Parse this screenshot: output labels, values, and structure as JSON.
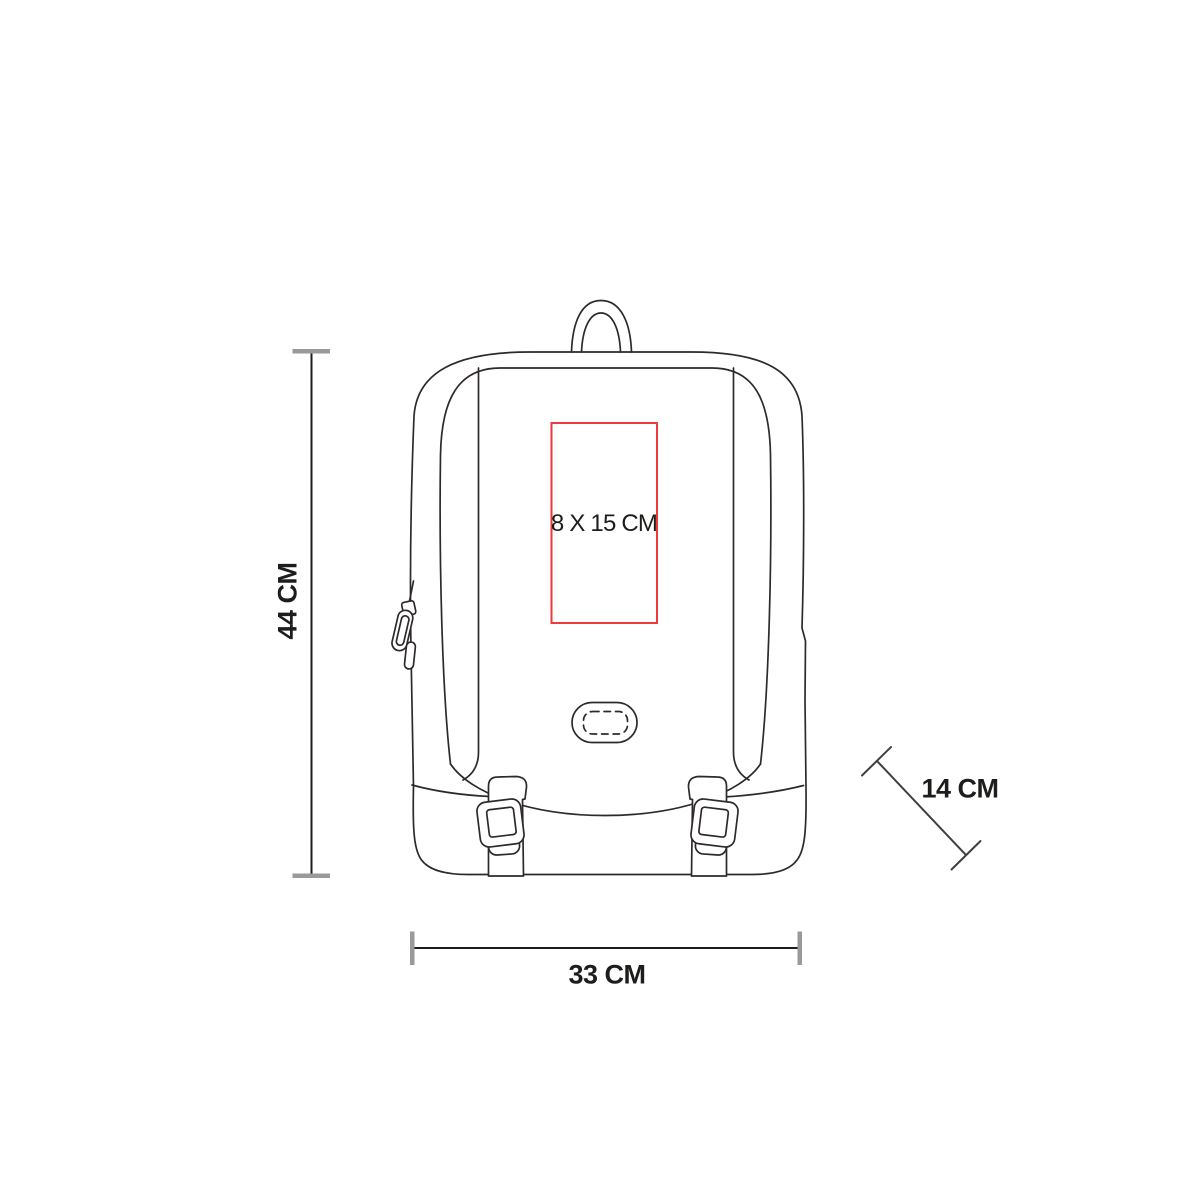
{
  "page": {
    "background": "#ffffff"
  },
  "diagram": {
    "subject": "Backpack front-view technical line drawing with print area and product dimensions",
    "print_area": {
      "label": "8 X 15 CM",
      "width_cm": 8,
      "height_cm": 15
    },
    "dimensions": {
      "height": {
        "label": "44 CM",
        "value_cm": 44,
        "orientation": "vertical"
      },
      "width": {
        "label": "33 CM",
        "value_cm": 33,
        "orientation": "horizontal"
      },
      "depth": {
        "label": "14 CM",
        "value_cm": 14,
        "orientation": "diagonal"
      }
    },
    "colors": {
      "outline": "#2e2a2b",
      "dimension_line": "#1c1c1c",
      "tick": "#9a9a9a",
      "diagonal_line": "#3f3f3f",
      "print_area_red": "#ee3a3f",
      "text": "#1d1d1b"
    }
  }
}
